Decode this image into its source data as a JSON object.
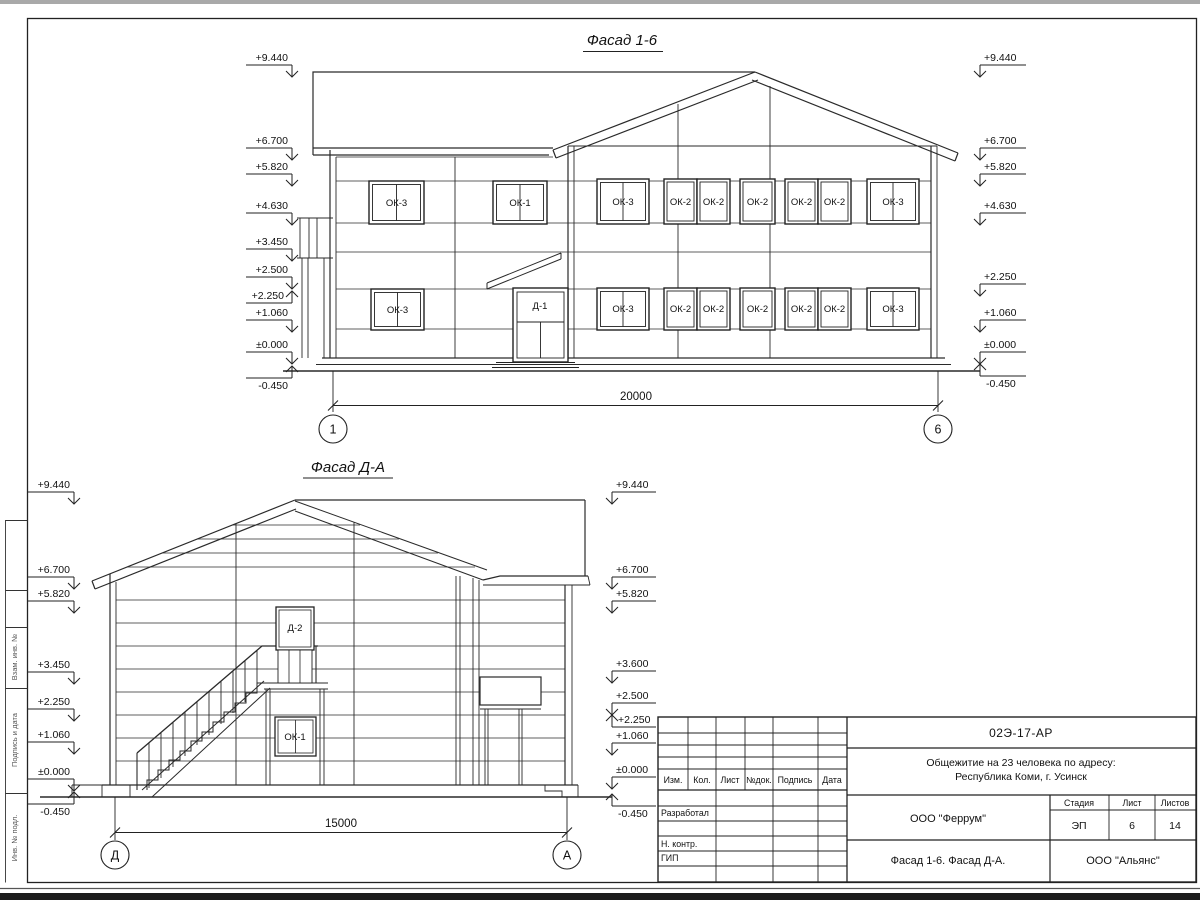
{
  "drawing": {
    "facade_1_6": {
      "title": "Фасад 1-6",
      "left_marks": [
        "+9.440",
        "+6.700",
        "+5.820",
        "+4.630",
        "+3.450",
        "+2.500",
        "+2.250",
        "+1.060",
        "±0.000",
        "-0.450"
      ],
      "right_marks": [
        "+9.440",
        "+6.700",
        "+5.820",
        "+4.630",
        "+2.250",
        "+1.060",
        "±0.000",
        "-0.450"
      ],
      "windows_upper": [
        "ОК-3",
        "ОК-1",
        "ОК-3",
        "ОК-2",
        "ОК-2",
        "ОК-2",
        "ОК-2",
        "ОК-2",
        "ОК-3"
      ],
      "windows_lower": [
        "ОК-3",
        "ОК-3",
        "ОК-2",
        "ОК-2",
        "ОК-2",
        "ОК-2",
        "ОК-2",
        "ОК-3"
      ],
      "door_label": "Д-1",
      "dim": "20000",
      "axis_left": "1",
      "axis_right": "6"
    },
    "facade_d_a": {
      "title": "Фасад Д-А",
      "left_marks": [
        "+9.440",
        "+6.700",
        "+5.820",
        "+3.450",
        "+2.250",
        "+1.060",
        "±0.000",
        "-0.450"
      ],
      "right_marks": [
        "+9.440",
        "+6.700",
        "+5.820",
        "+3.600",
        "+2.500",
        "+2.250",
        "+1.060",
        "±0.000",
        "-0.450"
      ],
      "door_label": "Д-2",
      "window_label": "ОК-1",
      "dim": "15000",
      "axis_left": "Д",
      "axis_right": "А"
    }
  },
  "side_stamp": {
    "labels": [
      "Взам. инв. №",
      "Подпись и дата",
      "Инв. № подл."
    ]
  },
  "title_block": {
    "doc_code": "02Э-17-АР",
    "project_name_line1": "Общежитие на 23 человека по адресу:",
    "project_name_line2": "Республика Коми, г. Усинск",
    "rev_columns": [
      "Изм.",
      "Кол.",
      "Лист",
      "№док.",
      "Подпись",
      "Дата"
    ],
    "sig_rows": [
      "Разработал",
      "Н. контр.",
      "ГИП"
    ],
    "designer_org": "ООО \"Феррум\"",
    "stage_label": "Стадия",
    "sheet_label": "Лист",
    "sheets_label": "Листов",
    "stage_value": "ЭП",
    "sheet_value": "6",
    "sheets_value": "14",
    "sheet_title": "Фасад 1-6. Фасад Д-А.",
    "client_org": "ООО \"Альянс\""
  }
}
